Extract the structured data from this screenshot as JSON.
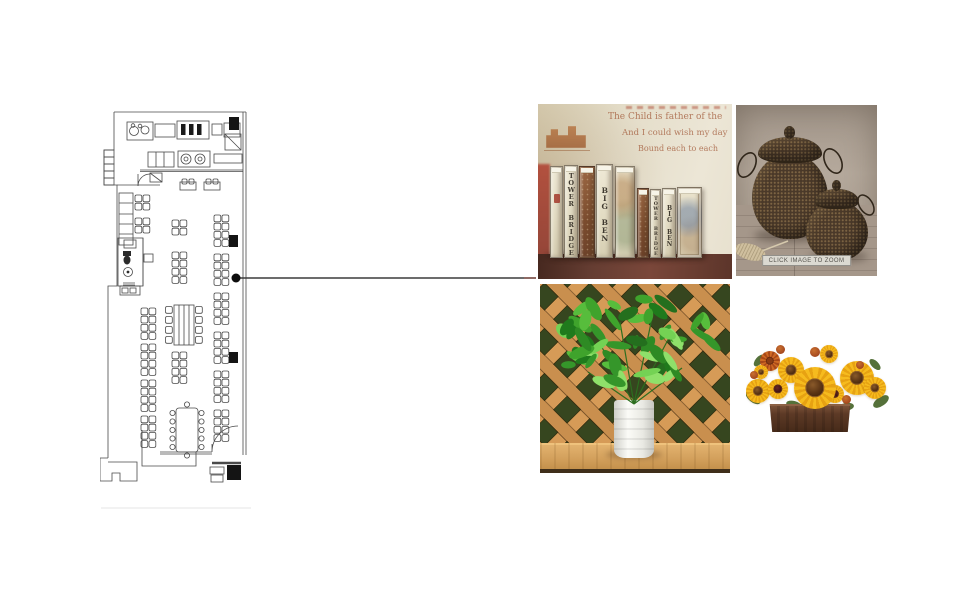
{
  "board": {
    "background": "#ffffff"
  },
  "floor_plan": {
    "type": "restaurant-floor-plan",
    "line_color": "#4a4a4a",
    "structural_column_color": "#141414"
  },
  "connector": {
    "line_color": "#3b3b3b",
    "dot_color": "#0d0d0d"
  },
  "photos": {
    "books": {
      "wall_text_lines": [
        "The Child is father of the",
        "And I could wish my day",
        "Bound each to each"
      ],
      "spine_labels": [
        "TOWER BRIDGE",
        "BIG BEN",
        "TOWER BRIDGE",
        "BIG BEN"
      ],
      "background_color": "#e4dcc6",
      "wood_color": "#653d32"
    },
    "baskets": {
      "caption": "CLICK IMAGE TO ZOOM",
      "basket_color": "#4a3929",
      "background_color": "#b0a497"
    },
    "plant": {
      "lattice_color": "#c98f4e",
      "leaf_color": "#3fa32c",
      "pot_color": "#f4f4ef"
    },
    "sunflowers": {
      "petal_color": "#f2b01a",
      "box_color": "#5d3a26"
    }
  }
}
